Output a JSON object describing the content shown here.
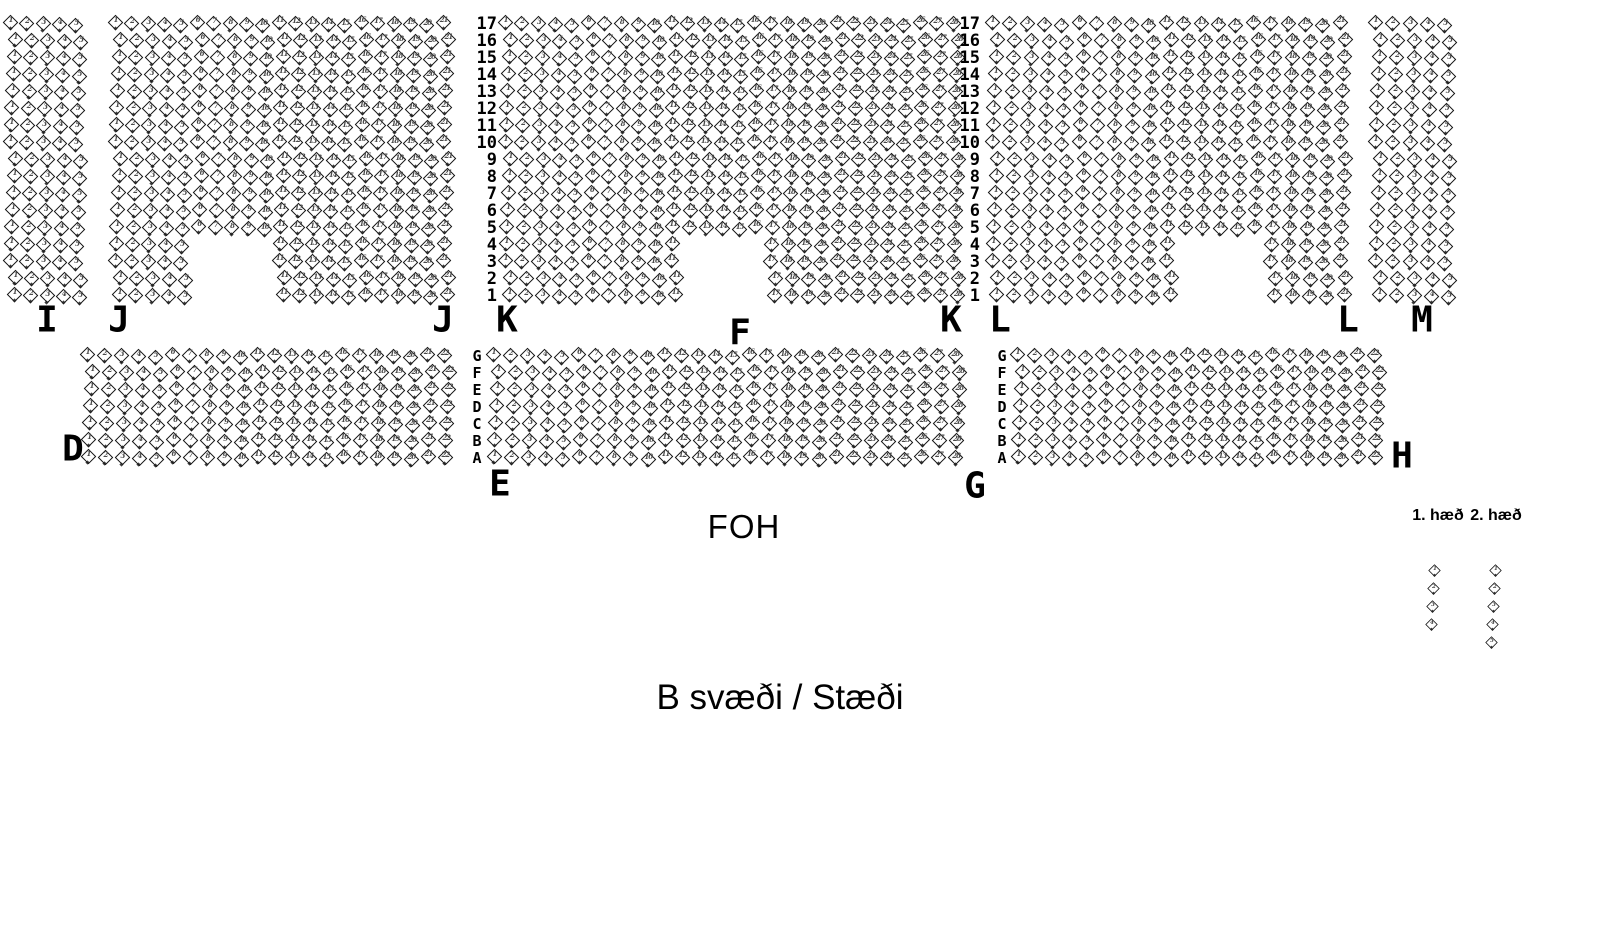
{
  "title": "B svæði / Stæði",
  "foh_label": "FOH",
  "legend": {
    "labels": [
      {
        "text": "1. hæð",
        "x": 1438,
        "y": 516
      },
      {
        "text": "2. hæð",
        "x": 1496,
        "y": 516
      }
    ],
    "columns": [
      {
        "x": 1434,
        "y": 570,
        "spacing": 18,
        "drift": -0.8,
        "seats": [
          "1",
          "2",
          "3",
          "4"
        ]
      },
      {
        "x": 1495,
        "y": 570,
        "spacing": 18,
        "drift": -0.8,
        "seats": [
          "1",
          "2",
          "3",
          "4",
          "5"
        ]
      }
    ]
  },
  "seat_map": {
    "seat_color": "#141414",
    "background": "#ffffff",
    "seat_numbering": "seats numbered 1..N left to right within each row",
    "row_numbers": [
      "17",
      "16",
      "15",
      "14",
      "13",
      "12",
      "11",
      "10",
      "9",
      "8",
      "7",
      "6",
      "5",
      "4",
      "3",
      "2",
      "1"
    ],
    "row_letters": [
      "G",
      "F",
      "E",
      "D",
      "C",
      "B",
      "A"
    ],
    "top": {
      "y": 24,
      "rows": 17,
      "row_spacing": 17.0
    },
    "bottom": {
      "y": 356,
      "rows": 7,
      "row_spacing": 17.0
    },
    "number_columns": [
      {
        "region": "top",
        "right_x": 497
      },
      {
        "region": "top",
        "right_x": 980
      }
    ],
    "letter_columns": [
      {
        "region": "bottom",
        "center_x": 477
      },
      {
        "region": "bottom",
        "center_x": 1002
      }
    ],
    "sections": [
      {
        "id": "I",
        "region": "top",
        "x": 13,
        "spacing": 16.4,
        "cols": 5,
        "labels": [
          {
            "text": "I",
            "x": 47,
            "y": 320
          }
        ]
      },
      {
        "id": "J",
        "region": "top",
        "x": 118,
        "spacing": 16.4,
        "cols": 21,
        "notch": {
          "rows": 4,
          "from": 6,
          "to": 10
        },
        "labels": [
          {
            "text": "J",
            "x": 119,
            "y": 320
          },
          {
            "text": "J",
            "x": 443,
            "y": 320
          }
        ]
      },
      {
        "id": "K",
        "region": "top",
        "x": 508,
        "spacing": 16.6,
        "cols": 28,
        "notch": {
          "rows": 4,
          "from": 12,
          "to": 16
        },
        "labels": [
          {
            "text": "K",
            "x": 507,
            "y": 320
          },
          {
            "text": "F",
            "x": 740,
            "y": 333
          },
          {
            "text": "K",
            "x": 951,
            "y": 320
          }
        ]
      },
      {
        "id": "L",
        "region": "top",
        "x": 995,
        "spacing": 17.4,
        "cols": 21,
        "notch": {
          "rows": 4,
          "from": 12,
          "to": 16
        },
        "labels": [
          {
            "text": "L",
            "x": 1000,
            "y": 320
          },
          {
            "text": "L",
            "x": 1348,
            "y": 320
          }
        ]
      },
      {
        "id": "M",
        "region": "top",
        "x": 1378,
        "spacing": 17.4,
        "cols": 5,
        "labels": [
          {
            "text": "M",
            "x": 1422,
            "y": 320
          }
        ]
      },
      {
        "id": "D",
        "region": "bottom",
        "x": 90,
        "spacing": 17.0,
        "cols": 22,
        "labels": [
          {
            "text": "D",
            "x": 73,
            "y": 449
          }
        ]
      },
      {
        "id": "E",
        "region": "bottom",
        "x": 496,
        "spacing": 17.1,
        "cols": 28,
        "labels": [
          {
            "text": "E",
            "x": 500,
            "y": 484
          },
          {
            "text": "G",
            "x": 975,
            "y": 486
          }
        ]
      },
      {
        "id": "H",
        "region": "bottom",
        "x": 1020,
        "spacing": 17.0,
        "cols": 22,
        "labels": [
          {
            "text": "H",
            "x": 1402,
            "y": 456
          }
        ]
      }
    ]
  }
}
